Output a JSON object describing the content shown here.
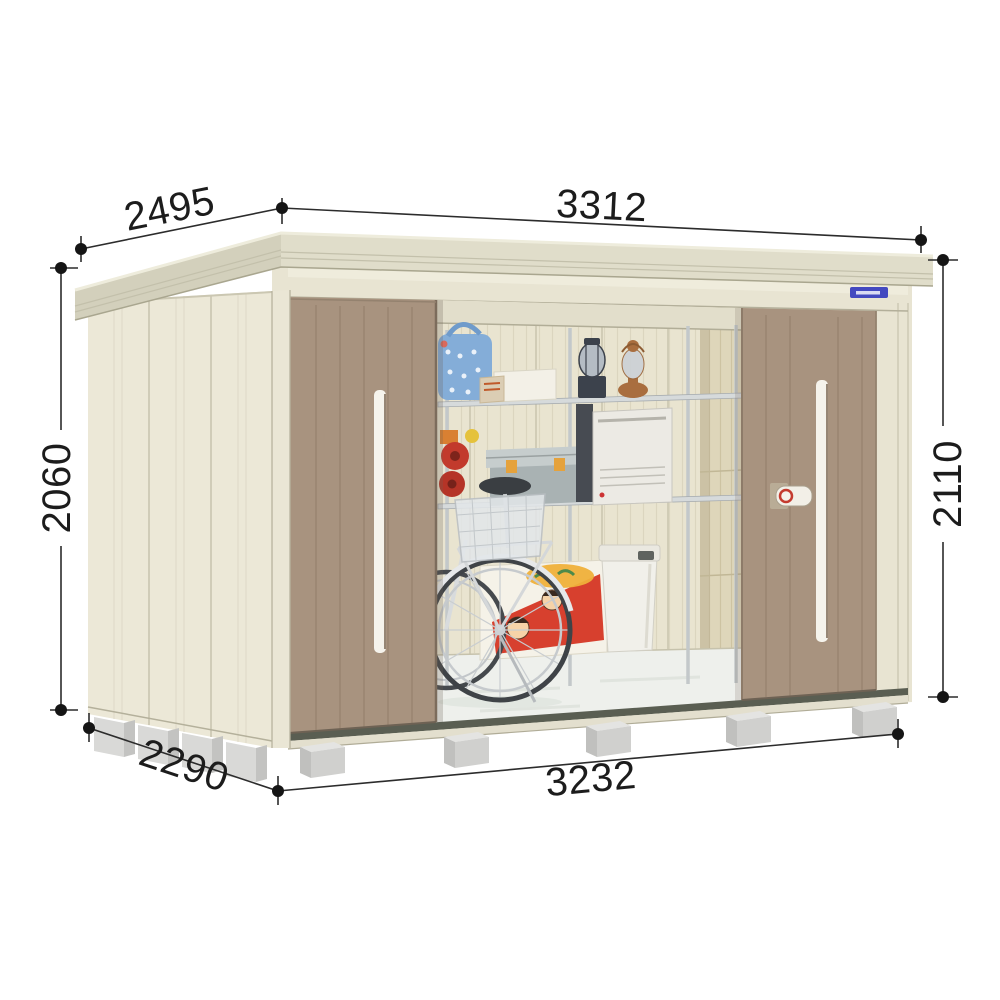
{
  "canvas": {
    "background": "#ffffff",
    "width": 1000,
    "height": 1000
  },
  "figure": {
    "type": "product-dimension-diagram",
    "subject": "steel storage shed with open sliding doors showing stored items",
    "view": "front-left perspective"
  },
  "dimensions": {
    "top_depth": "2495",
    "top_width": "3312",
    "left_height": "2060",
    "right_height": "2110",
    "bottom_depth": "2290",
    "bottom_width": "3232"
  },
  "colors": {
    "roof_fascia": "#e0ddca",
    "roof_side": "#d3d0bc",
    "wall": "#ece8d7",
    "front_trim": "#e8e4d2",
    "door": "#a8937f",
    "handle": "#f5f3ec",
    "interior_wall": "#e9e4d0",
    "interior_wall_right": "#ded6ba",
    "floor": "#eef0ec",
    "base_rail": "#5a5e52",
    "foundation_block": "#d0d0ce",
    "dimension_line": "#2c2c2c",
    "brand_badge": "#4349c0"
  },
  "interior_items": [
    "steel-shelving",
    "laundry-basket",
    "storage-boxes",
    "camping-lantern",
    "oil-lantern",
    "cable-reel",
    "storage-container",
    "kerosene-heater",
    "bicycle",
    "illustrated-carton",
    "waste-bin"
  ]
}
